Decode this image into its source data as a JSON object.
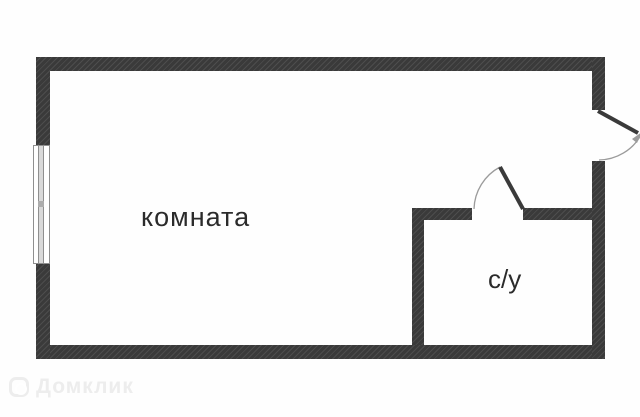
{
  "plan": {
    "rooms": [
      {
        "id": "room",
        "label": "комната"
      },
      {
        "id": "bathroom",
        "label": "с/у"
      }
    ]
  },
  "watermark": {
    "label": "Домклик",
    "icon": "domclick-logo-icon"
  },
  "colors": {
    "bg": "#fefefe",
    "wall": "#3a3a3a",
    "wall_hatch": "#4d4d4d",
    "frame": "#8f8f8f",
    "glass": "#d9d9d9",
    "arc": "#9b9b9b",
    "label": "#2b2b2b",
    "watermark": "#ededed"
  }
}
